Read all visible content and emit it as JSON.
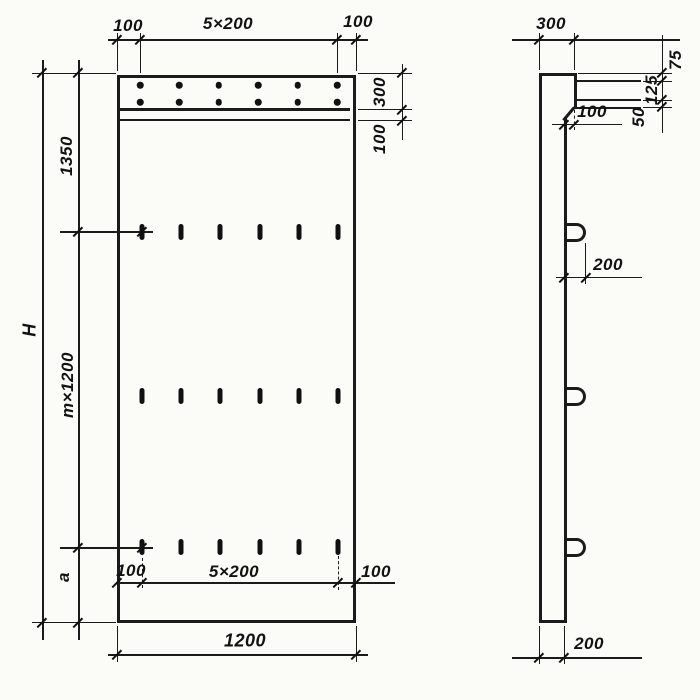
{
  "drawing": {
    "front_view": {
      "top_dimensions": {
        "left_margin": "100",
        "spacing": "5×200",
        "right_margin": "100"
      },
      "right_dimensions": {
        "top_strip": "300",
        "sub_strip": "100"
      },
      "left_dimensions": {
        "overall_height": "H",
        "top_segment": "1350",
        "middle_segment": "m×1200",
        "bottom_segment": "a"
      },
      "inner_bottom_dimensions": {
        "left_margin": "100",
        "spacing": "5×200",
        "right_margin": "100"
      },
      "overall_width": "1200"
    },
    "side_view": {
      "top_width": "300",
      "right_dimensions": {
        "first": "75",
        "second": "125",
        "third": "50"
      },
      "step_offset": "100",
      "loop_offset": "200",
      "panel_thickness": "200"
    }
  }
}
